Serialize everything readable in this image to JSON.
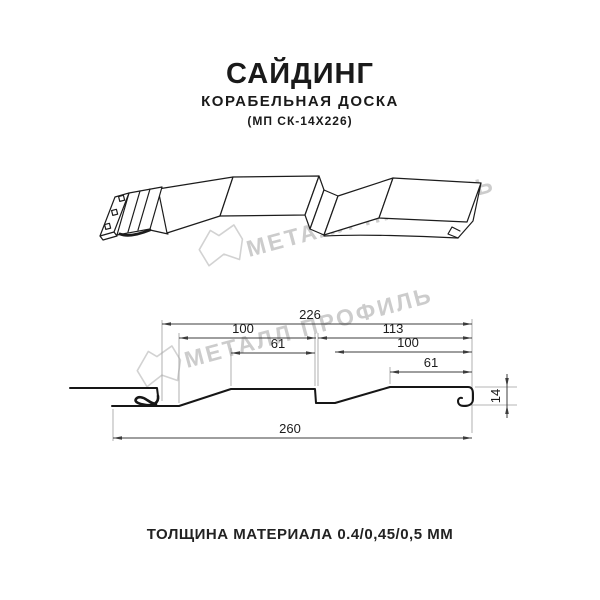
{
  "header": {
    "title": "САЙДИНГ",
    "subtitle": "КОРАБЕЛЬНАЯ ДОСКА",
    "model": "(МП СК-14Х226)"
  },
  "watermark": {
    "brand": "МЕТАЛЛ ПРОФИЛЬ"
  },
  "diagram": {
    "type": "technical-profile-drawing",
    "product": "siding panel cross-section",
    "units": "mm",
    "dimensions": {
      "overall_width": "260",
      "cover_width": "226",
      "board1_width": "100",
      "board1_flat": "61",
      "board2_span": "113",
      "board2_width": "100",
      "board2_flat": "61",
      "profile_height": "14"
    }
  },
  "footer": {
    "thickness": "ТОЛЩИНА МАТЕРИАЛА 0.4/0,45/0,5 ММ"
  }
}
